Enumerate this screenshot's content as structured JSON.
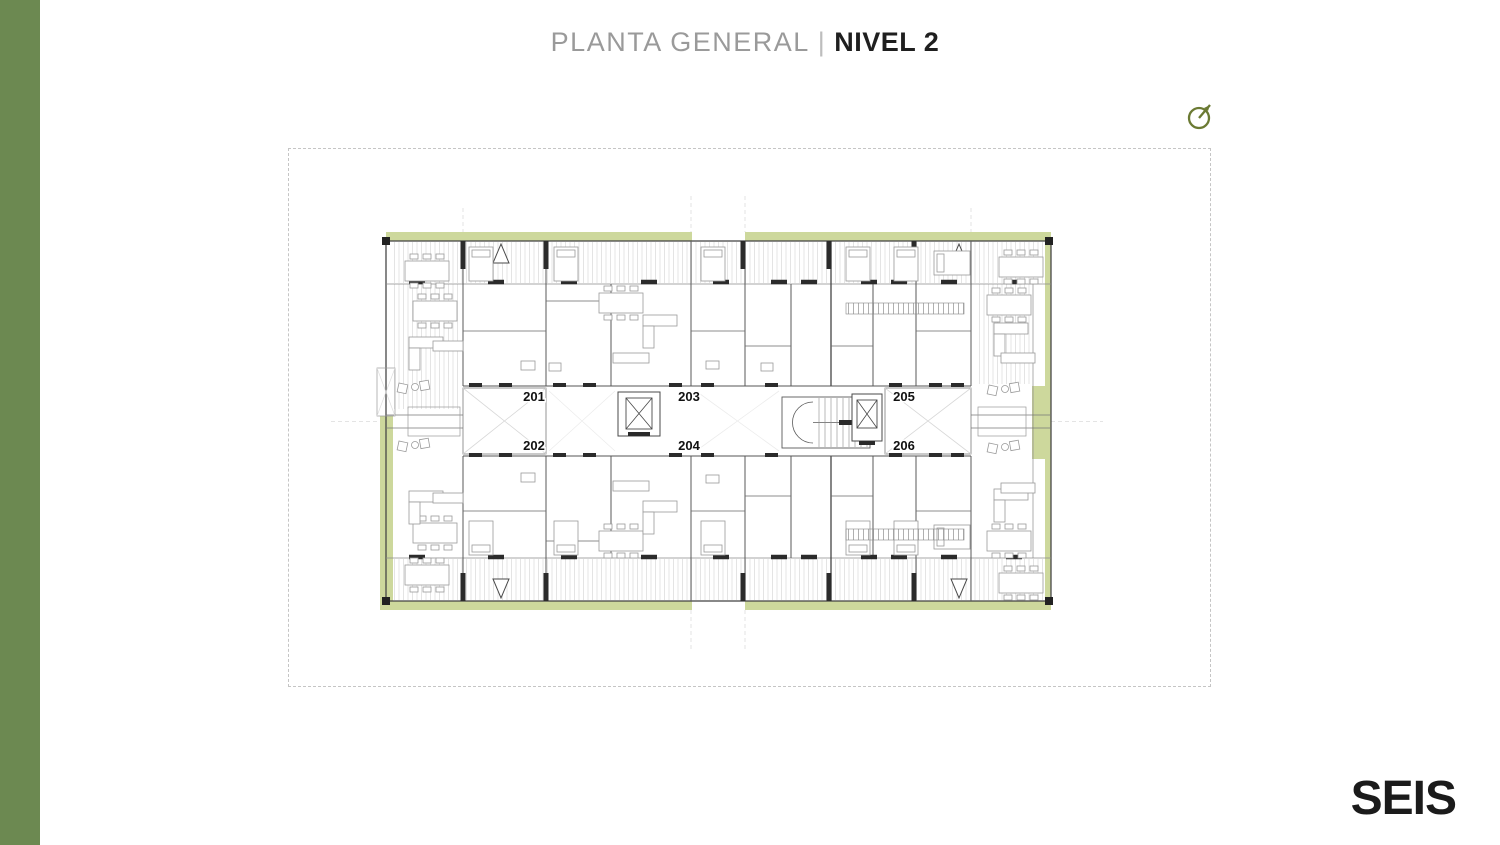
{
  "header": {
    "title_light": "PLANTA GENERAL",
    "separator": "|",
    "title_bold": "NIVEL 2"
  },
  "sidebar": {
    "accent_color": "#6c8951"
  },
  "compass": {
    "icon": "north-indicator-icon",
    "color": "#6b7a33"
  },
  "plan": {
    "kind": "architectural-floor-plan",
    "terrace_color": "#cdd89c",
    "wall_color": "#4a4a4a",
    "furniture_color": "#9a9a9a",
    "unit_numbers": [
      "201",
      "202",
      "203",
      "204",
      "205",
      "206"
    ]
  },
  "footer": {
    "logo": "SEIS"
  }
}
